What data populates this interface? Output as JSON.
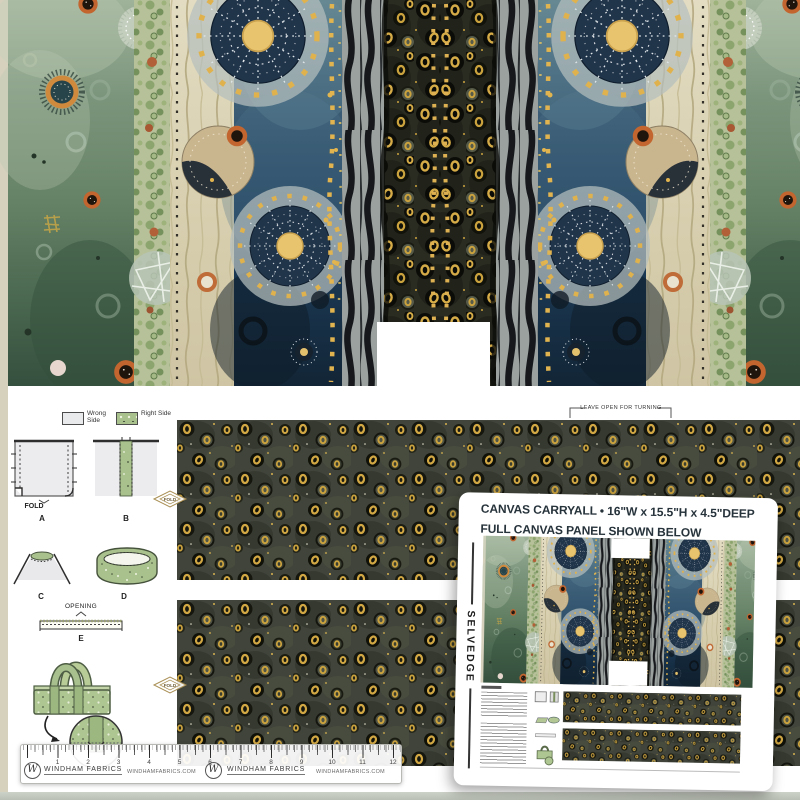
{
  "legend": {
    "wrong_side": "Wrong Side",
    "right_side": "Right Side"
  },
  "diagram_labels": {
    "a": "A",
    "b": "B",
    "c": "C",
    "d": "D",
    "e": "E"
  },
  "captions": {
    "fold": "FOLD",
    "opening": "OPENING",
    "leave_open": "LEAVE OPEN FOR TURNING"
  },
  "card": {
    "title_line1": "CANVAS CARRYALL • 16\"W x 15.5\"H x 4.5\"DEEP",
    "title_line2": "FULL CANVAS PANEL SHOWN BELOW",
    "selvedge": "SELVEDGE"
  },
  "ruler": {
    "numbers": [
      "1",
      "2",
      "3",
      "4",
      "5",
      "6",
      "7",
      "8",
      "9",
      "10",
      "11",
      "12"
    ],
    "brand": "WINDHAM FABRICS",
    "brand_monogram": "W",
    "website": "WINDHAMFABRICS.COM"
  },
  "colors": {
    "accent_gold": "#d4ab47",
    "fabric_dark_ground": "#40443a",
    "blue_band": "#2b4c67",
    "green_band": "#6d8873",
    "bag_green": "#aec691",
    "card_text": "#27333b"
  }
}
